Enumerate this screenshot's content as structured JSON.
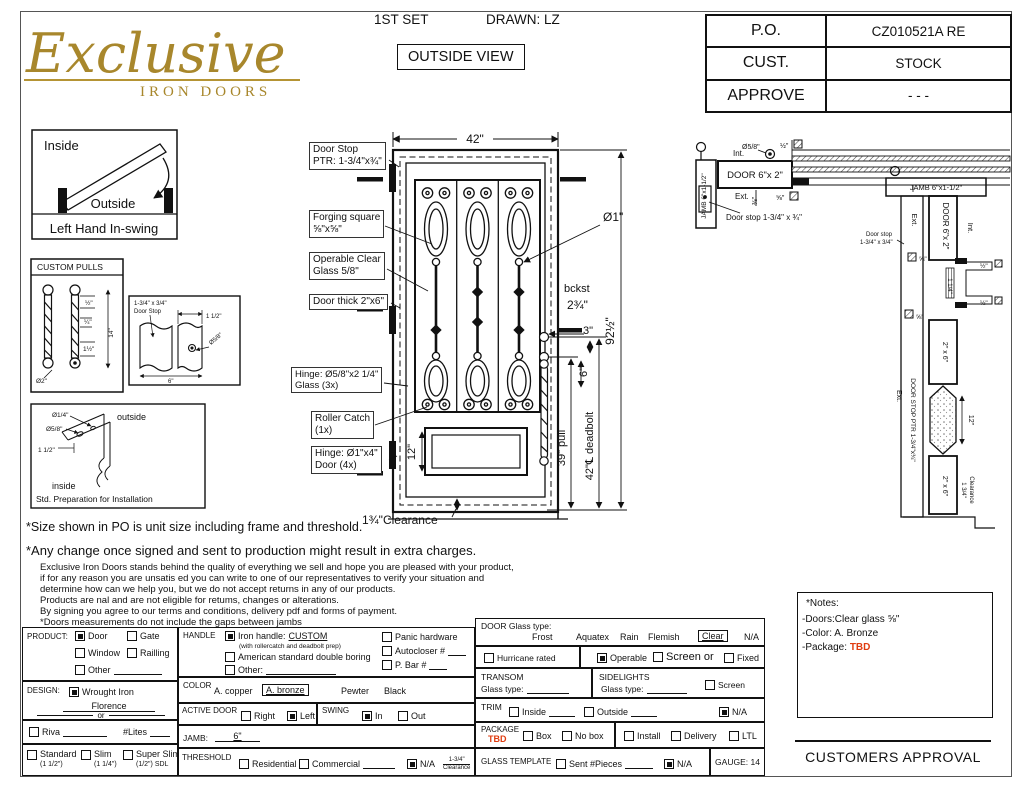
{
  "logo": {
    "name": "Exclusive",
    "subtitle": "IRON DOORS"
  },
  "header": {
    "set": "1ST SET",
    "drawn": "DRAWN: LZ",
    "view": "OUTSIDE VIEW"
  },
  "po_table": {
    "r1l": "P.O.",
    "r1v": "CZ010521A RE",
    "r2l": "CUST.",
    "r2v": "STOCK",
    "r3l": "APPROVE",
    "r3v": "- - -"
  },
  "swing": {
    "inside": "Inside",
    "outside": "Outside",
    "caption": "Left Hand In-swing"
  },
  "pulls": {
    "title": "CUSTOM PULLS",
    "d_half": "½\"",
    "d_quarter": "¼\"",
    "d_1half": "1½\"",
    "d_14": "14\"",
    "d_dia2": "Ø2\""
  },
  "stop_detail": {
    "l1": "1-3/4\" x 3/4\"",
    "l2": "Door Stop",
    "d1": "1 1/2\"",
    "d2": "Ø5/8\"",
    "d3": "6\""
  },
  "prep": {
    "d1": "Ø1/4\"",
    "d2": "Ø5/8\"",
    "d3": "1 1/2\"",
    "outside": "outside",
    "inside": "inside",
    "caption": "Std. Preparation for Installation"
  },
  "door": {
    "dim_w": "42\"",
    "dim_h": "92½\"",
    "dia1": "Ø1\"",
    "bckst1": "bckst",
    "bckst2": "2¾\"",
    "dim3": "3\"",
    "dim6": "6\"",
    "pull": "39\" pull",
    "deadbolt": "42\"℄ deadbolt",
    "panel12": "12\"",
    "clearance": "1¾\"Clearance",
    "co_stop": "Door Stop\nPTR: 1-3/4\"x¾\"",
    "co_forge": "Forging square\n⅝\"x⅝\"",
    "co_glass": "Operable Clear\nGlass 5/8\"",
    "co_thick": "Door thick 2\"x6\"",
    "co_hinge_g": "Hinge: Ø5/8\"x2 1/4\"\nGlass (3x)",
    "co_roller": "Roller Catch\n(1x)",
    "co_hinge_d": "Hinge: Ø1\"x4\"\nDoor (4x)"
  },
  "sectionH": {
    "jamb": "JAMB 6\"x1-1/2\"",
    "door": "DOOR 6\"x 2\"",
    "int": "Int.",
    "ext": "Ext.",
    "dia58": "Ø5/8\"",
    "half": "½\"",
    "te": "⅜\"",
    "fe": "⅝\"",
    "stop": "Door stop 1-3/4\" x ¾\""
  },
  "sectionV": {
    "jamb": "JAMB 6\"x1-1/2\"",
    "door": "DOOR 6\"x 2\"",
    "int": "Int.",
    "ext1": "Ext.",
    "ext2": "Ext.",
    "stop1": "Door stop",
    "stop2": "1-3/4\" x 3/4\"",
    "fe1": "⅝\"",
    "fe2": "⅝\"",
    "half1": "½\"",
    "half2": "½\"",
    "oq": "1 1/4\"",
    "t26a": "2\" x 6\"",
    "t26b": "2\" x 6\"",
    "twelve": "12\"",
    "dsp": "DOOR STOP PTR 1-3/4\"x¾\"",
    "clr1": "1 3/4\"",
    "clr2": "Clearance"
  },
  "disclaimer": {
    "l1": "*Size shown in PO is unit size including frame and threshold.",
    "l2": "*Any change once signed and sent to production might result in extra charges.",
    "s1": "Exclusive Iron Doors stands behind the quality of everything we sell and hope you are pleased with your product,",
    "s2": "if for any reason you are unsatis ed you can write to one of our representatives to verify your situation and",
    "s3": "determine how can we help you, but we do not accept returns in any of our products.",
    "s4": "Products are  nal and are not eligible for retums, changes or alterations.",
    "s5": "By signing you agree to our terms and conditions, delivery pdf and forms of payment.",
    "s6": "*Doors measurements do not include the gaps between jambs"
  },
  "form": {
    "product": {
      "label": "PRODUCT:",
      "door": "Door",
      "gate": "Gate",
      "window": "Window",
      "railling": "Railling",
      "other": "Other"
    },
    "design": {
      "label": "DESIGN:",
      "wrought": "Wrought Iron",
      "florence": "Florence",
      "or": "or"
    },
    "riva": {
      "riva": "Riva",
      "lites": "#Lites"
    },
    "frames": {
      "standard": "Standard",
      "standard_s": "(1 1/2\")",
      "slim": "Slim",
      "slim_s": "(1 1/4\")",
      "superslim": "Super Slim",
      "superslim_s": "(1/2\") SDL"
    },
    "handle": {
      "label": "HANDLE",
      "iron": "Iron handle:",
      "custom": "CUSTOM",
      "note": "(with rollercatch and deadbolt prep)",
      "american": "American standard double boring",
      "other": "Other:",
      "panic": "Panic hardware",
      "autocloser": "Autocloser #",
      "pbar": "P. Bar #"
    },
    "color": {
      "label": "COLOR",
      "copper": "A. copper",
      "bronze": "A. bronze",
      "pewter": "Pewter",
      "black": "Black"
    },
    "active": {
      "label": "ACTIVE DOOR",
      "right": "Right",
      "left": "Left"
    },
    "swing": {
      "label": "SWING",
      "in": "In",
      "out": "Out"
    },
    "jamb": {
      "label": "JAMB:",
      "value": "6\""
    },
    "threshold": {
      "label": "THRESHOLD",
      "res": "Residential",
      "com": "Commercial",
      "na": "N/A",
      "note1": "1-3/4\"",
      "note2": "Clearance"
    },
    "glass": {
      "label": "DOOR Glass type:",
      "frost": "Frost",
      "aquatex": "Aquatex",
      "rain": "Rain",
      "flemish": "Flemish",
      "clear": "Clear",
      "na": "N/A"
    },
    "hurricane": "Hurricane rated",
    "operable": {
      "operable": "Operable",
      "screen": "Screen or",
      "fixed": "Fixed"
    },
    "transom": {
      "label": "TRANSOM",
      "glass": "Glass type:"
    },
    "sidelights": {
      "label": "SIDELIGHTS",
      "glass": "Glass type:",
      "screen": "Screen"
    },
    "trim": {
      "label": "TRIM",
      "inside": "Inside",
      "outside": "Outside",
      "na": "N/A"
    },
    "package": {
      "label": "PACKAGE",
      "tbd": "TBD",
      "box": "Box",
      "nobox": "No box",
      "install": "Install",
      "delivery": "Delivery",
      "ltl": "LTL"
    },
    "template": {
      "label": "GLASS TEMPLATE",
      "sent": "Sent #Pieces",
      "na": "N/A"
    },
    "gauge": "GAUGE: 14"
  },
  "notes": {
    "title": "*Notes:",
    "line1": "-Doors:Clear glass ⅝\"",
    "line2": "-Color: A. Bronze",
    "pkg_label": "-Package: ",
    "pkg_value": "TBD"
  },
  "approval": "CUSTOMERS APPROVAL"
}
